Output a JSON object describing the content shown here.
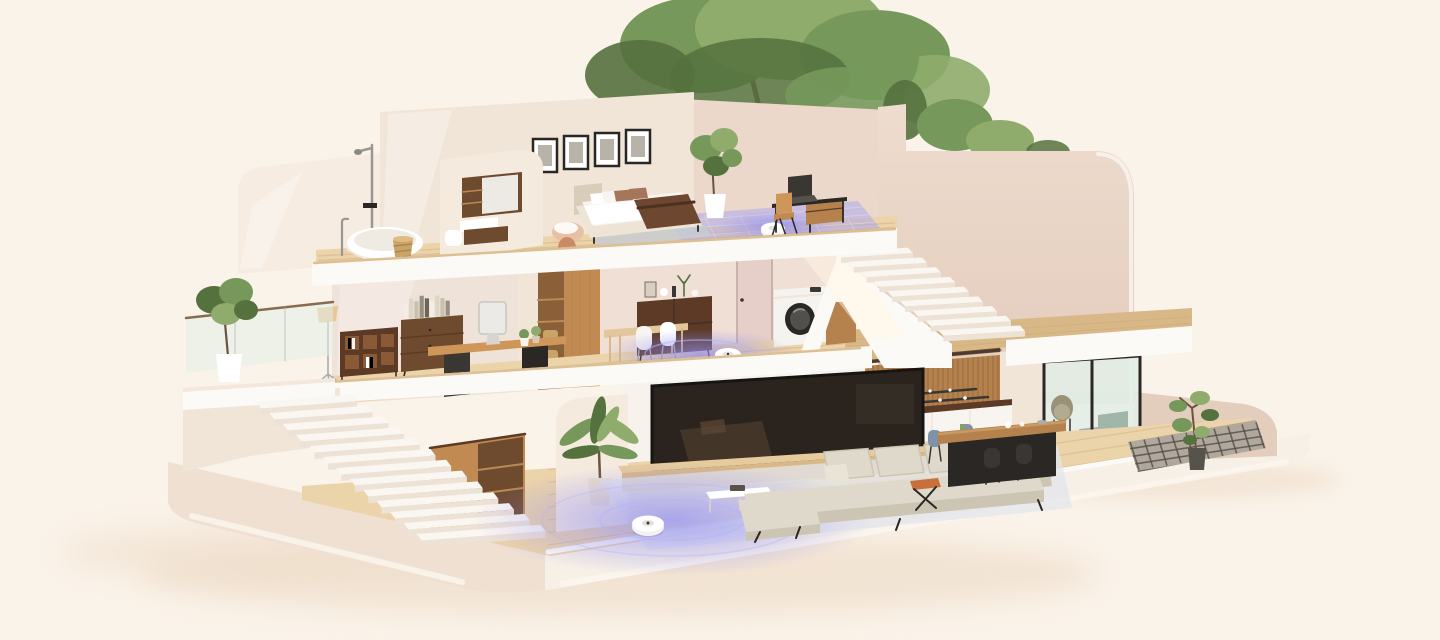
{
  "scene": {
    "title": "Isometric cutaway 3D render of a three-story smart home; robot vacuums highlight cleaning zones in glowing lavender",
    "robots": {
      "count": 3,
      "body_color": "#F4F3F0",
      "zone_color": "#8F8CF2"
    },
    "counts": {
      "gallery_frames": 4,
      "exterior_steps": 13,
      "interior_steps": 9
    },
    "library": {
      "spine_colors": [
        "#F3EEE5",
        "#DDD5C6",
        "#C9C0AE",
        "#979081",
        "#6E6457"
      ]
    },
    "floors": [
      {
        "name": "top-floor",
        "rooms": [
          {
            "name": "bathroom",
            "objects": [
              "freestanding-bathtub",
              "floor-faucet",
              "shower-column",
              "woven-laundry-basket",
              "vanity-mirror",
              "wall-shelf-unit",
              "washbasin",
              "wall-drawer",
              "toilet"
            ]
          },
          {
            "name": "bedroom",
            "objects": [
              "upholstered-double-bed",
              "white-pillows",
              "brown-pillows",
              "dark-brown-throw",
              "gallery-wall-4-frames",
              "potted-plant",
              "peach-ottoman",
              "clay-vase",
              "gray-area-rug"
            ]
          },
          {
            "name": "study-nook",
            "objects": [
              "black-writing-desk",
              "wood-drawer-box",
              "laptop",
              "wooden-chair",
              "robot-vacuum",
              "mapped-cleaning-zone"
            ]
          }
        ]
      },
      {
        "name": "middle-floor",
        "rooms": [
          {
            "name": "terrace",
            "objects": [
              "glass-railing",
              "fiddle-leaf-fig-plant",
              "white-planter"
            ]
          },
          {
            "name": "home-office",
            "objects": [
              "floor-lamp",
              "cubby-bookshelf",
              "walnut-credenza",
              "stacked-books",
              "wood-desk",
              "desktop-computer",
              "desk-plants"
            ]
          },
          {
            "name": "hallway",
            "objects": [
              "wardrobe-closet",
              "storage-baskets",
              "interior-door"
            ]
          },
          {
            "name": "dining-nook",
            "objects": [
              "walnut-sideboard",
              "decor-vases",
              "dining-table",
              "two-white-chairs"
            ]
          },
          {
            "name": "laundry",
            "objects": [
              "washing-machine",
              "wood-cabinet",
              "detergent-box"
            ]
          },
          {
            "name": "landing",
            "objects": [
              "white-staircase",
              "sunbeam",
              "robot-vacuum",
              "cleaning-zone-glow"
            ]
          }
        ]
      },
      {
        "name": "ground-floor",
        "rooms": [
          {
            "name": "living-room",
            "objects": [
              "wall-tv",
              "media-console",
              "soundbar-led",
              "sectional-sofa",
              "beige-cushions",
              "coffee-table",
              "area-rug",
              "robot-vacuum",
              "cleaning-zone-glow",
              "palm-plant",
              "rounded-partition",
              "under-stair-cabinet",
              "orange-folding-stool"
            ]
          },
          {
            "name": "kitchen",
            "objects": [
              "stainless-french-door-fridge",
              "wood-soffit",
              "slatted-upper-cabinets",
              "open-shelves",
              "walnut-countertop",
              "sink",
              "black-faucet",
              "white-base-cabinets",
              "wood-top-island",
              "two-blue-chairs",
              "two-black-chairs",
              "tableware"
            ]
          },
          {
            "name": "patio",
            "objects": [
              "sliding-glass-door",
              "wicker-chair",
              "green-outdoor-cabinet",
              "grass-strip",
              "dark-grid-tiles",
              "rubber-plant",
              "low-curved-wall"
            ]
          },
          {
            "name": "exterior",
            "objects": [
              "wide-white-staircase",
              "base-plinth",
              "soft-ground-shadow"
            ]
          }
        ]
      }
    ],
    "landscaping": [
      "large-backyard-tree",
      "rooftop-shrubs",
      "side-shrubs"
    ]
  },
  "palette": {
    "bg": "#FAF3E9",
    "bgShadow": "#EDD9C5",
    "baseFaceL": "#F0E0D2",
    "baseFaceR": "#F7F0E7",
    "baseEdge": "#FBF6EF",
    "slab": "#FCFAF6",
    "slabShade": "#EFE5D9",
    "woodFloor": "#EBD3AA",
    "woodFloorDark": "#DFC195",
    "woodStrip": "#D9B887",
    "plank": "#C09A6A",
    "wallCream": "#F6ECE1",
    "wallCream2": "#F1E5D7",
    "wallPink": "#EBD8CA",
    "wallPinkDark": "#E3CDBD",
    "wallMauve": "#F0DFD5",
    "wallInner": "#EFE2D8",
    "tvWall": "#F7F2EC",
    "partition": "#F4EADD",
    "woodDark": "#6E4A2F",
    "woodDarker": "#5C3A26",
    "woodMid": "#B5824E",
    "woodWarm": "#C08A52",
    "woodSoft": "#CE9659",
    "oak": "#E3C79C",
    "oakLight": "#E6CB9D",
    "oakFace": "#D9B887",
    "soffit": "#7A5433",
    "closetIn": "#8A6038",
    "closetShelf": "#B98A54",
    "black": "#2A2724",
    "charcoal": "#3A3632",
    "steel": "#C2C6C9",
    "steelDark": "#A8ADB1",
    "chrome": "#9A9793",
    "white": "#FFFFFF",
    "offWhite": "#F8F5F1",
    "stepTread": "#FAF6F1",
    "stepRiser": "#EDE2D6",
    "glow": "#8F8CF2",
    "glowSoft": "#B7B4F7",
    "glowPatch": "#A7A4EF",
    "rug": "#E3E6EC",
    "bedRug": "#C6CDD4",
    "sofa": "#DFD9CB",
    "sofaShade": "#CDC5B4",
    "pillowLight": "#EAE4D6",
    "green": "#76985B",
    "greenDark": "#55713E",
    "greenLight": "#8FAC6C",
    "trunk": "#6A5340",
    "glass": "#E2EEE7",
    "grass": "#7FA05F",
    "orange": "#C8703C",
    "chairBlue": "#7E92A8",
    "clay": "#C98A66",
    "peach": "#E8C0A4",
    "basket": "#C9A368",
    "pillowBrown": "#A5765C",
    "throw": "#6E4730",
    "headboard": "#D9CDBA",
    "bedFrame": "#EDE4D6",
    "tvScreen": "#2B241E",
    "tvReflect": "#4A392A",
    "lamp": "#E9C897",
    "ledPurple": "#B06AD0",
    "tile": "#B0A89D",
    "tileLine": "#524D47",
    "doorMauve": "#E6CFC8",
    "washerWhite": "#F5F3F0",
    "sunbeam": "#FFF6E4"
  }
}
